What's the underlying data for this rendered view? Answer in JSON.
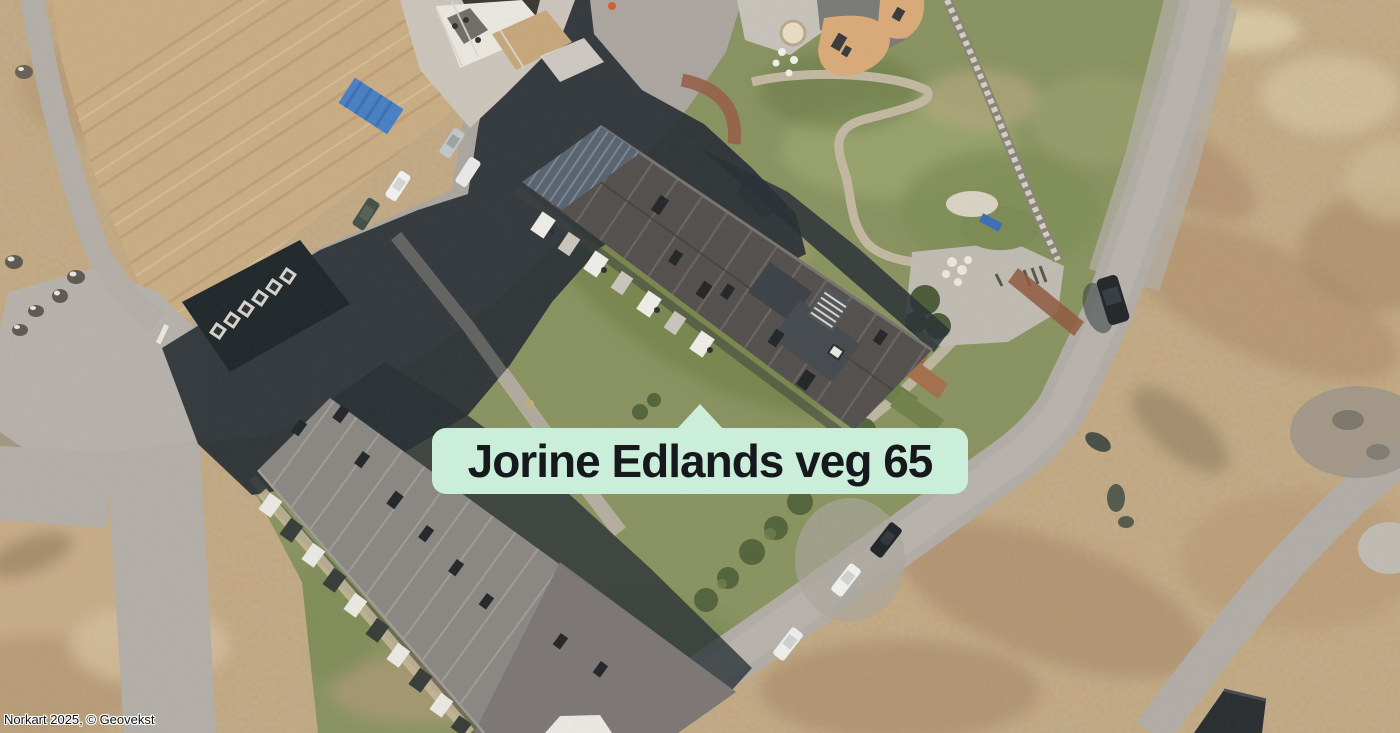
{
  "page": {
    "width": 1400,
    "height": 733
  },
  "map_label": {
    "text": "Jorine Edlands veg 65",
    "background": "#cbeeda",
    "text_color": "#15181c",
    "pointer_target": {
      "x": 700,
      "y": 404
    }
  },
  "attribution": {
    "text": "Norkart 2025, © Geovekst"
  },
  "map": {
    "type": "aerial-orthophoto",
    "visible_features": [
      "labeled-apartment-building",
      "south-apartment-building",
      "construction-site",
      "playground",
      "parking-with-cars",
      "roads",
      "lawn",
      "heathland",
      "stone-wall"
    ]
  }
}
